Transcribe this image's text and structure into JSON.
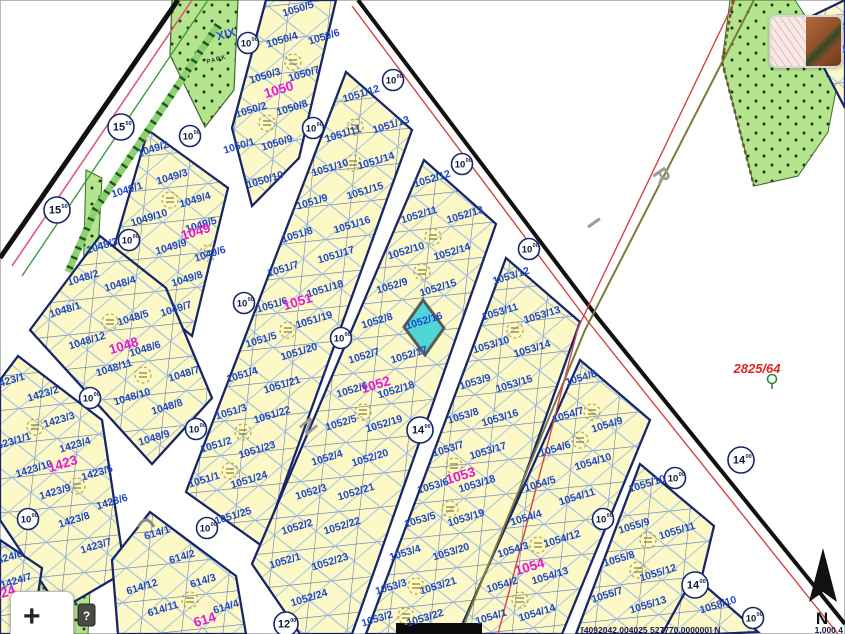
{
  "map": {
    "colors": {
      "parcel_number": "#1d46c8",
      "block_number": "#e318d6",
      "highlight_fill": "#4fd6d6",
      "selection_outline": "#5a5a5a",
      "survey_red": "#e02525"
    },
    "highlight": {
      "parcel": "1052/16"
    },
    "parcel_labels": [
      {
        "t": "1050/5",
        "x": 299,
        "y": 12
      },
      {
        "t": "1050/4",
        "x": 283,
        "y": 43
      },
      {
        "t": "1050/6",
        "x": 325,
        "y": 40
      },
      {
        "t": "1050/3",
        "x": 266,
        "y": 79
      },
      {
        "t": "1050/7",
        "x": 305,
        "y": 77
      },
      {
        "t": "1050/2",
        "x": 252,
        "y": 113
      },
      {
        "t": "1050/8",
        "x": 293,
        "y": 111
      },
      {
        "t": "1050/1",
        "x": 240,
        "y": 149
      },
      {
        "t": "1050/9",
        "x": 278,
        "y": 146
      },
      {
        "t": "1050/10",
        "x": 266,
        "y": 183
      },
      {
        "t": "1051/12",
        "x": 362,
        "y": 97
      },
      {
        "t": "1051/13",
        "x": 392,
        "y": 128
      },
      {
        "t": "1051/11",
        "x": 344,
        "y": 137
      },
      {
        "t": "1051/14",
        "x": 377,
        "y": 164
      },
      {
        "t": "1051/10",
        "x": 331,
        "y": 171
      },
      {
        "t": "1051/15",
        "x": 366,
        "y": 194
      },
      {
        "t": "1051/9",
        "x": 313,
        "y": 205
      },
      {
        "t": "1051/16",
        "x": 353,
        "y": 228
      },
      {
        "t": "1051/8",
        "x": 298,
        "y": 238
      },
      {
        "t": "1051/17",
        "x": 337,
        "y": 258
      },
      {
        "t": "1051/7",
        "x": 284,
        "y": 272
      },
      {
        "t": "1051/18",
        "x": 326,
        "y": 292
      },
      {
        "t": "1051/6",
        "x": 273,
        "y": 308
      },
      {
        "t": "1051/19",
        "x": 315,
        "y": 323
      },
      {
        "t": "1051/5",
        "x": 262,
        "y": 343
      },
      {
        "t": "1051/20",
        "x": 300,
        "y": 355
      },
      {
        "t": "1051/4",
        "x": 243,
        "y": 378
      },
      {
        "t": "1051/21",
        "x": 283,
        "y": 388
      },
      {
        "t": "1051/3",
        "x": 232,
        "y": 415
      },
      {
        "t": "1051/22",
        "x": 273,
        "y": 418
      },
      {
        "t": "1051/2",
        "x": 217,
        "y": 448
      },
      {
        "t": "1051/23",
        "x": 258,
        "y": 453
      },
      {
        "t": "1051/1",
        "x": 205,
        "y": 483
      },
      {
        "t": "1051/24",
        "x": 250,
        "y": 483
      },
      {
        "t": "1051/25",
        "x": 234,
        "y": 519
      },
      {
        "t": "1052/12",
        "x": 433,
        "y": 182
      },
      {
        "t": "1052/11",
        "x": 420,
        "y": 218
      },
      {
        "t": "1052/13",
        "x": 466,
        "y": 218
      },
      {
        "t": "1052/10",
        "x": 407,
        "y": 254
      },
      {
        "t": "1052/14",
        "x": 453,
        "y": 255
      },
      {
        "t": "1052/9",
        "x": 393,
        "y": 289
      },
      {
        "t": "1052/15",
        "x": 439,
        "y": 291
      },
      {
        "t": "1052/8",
        "x": 378,
        "y": 324
      },
      {
        "t": "1052/16",
        "x": 425,
        "y": 324
      },
      {
        "t": "1052/7",
        "x": 365,
        "y": 359
      },
      {
        "t": "1052/17",
        "x": 410,
        "y": 358
      },
      {
        "t": "1052/6",
        "x": 353,
        "y": 393
      },
      {
        "t": "1052/18",
        "x": 397,
        "y": 393
      },
      {
        "t": "1052/5",
        "x": 342,
        "y": 426
      },
      {
        "t": "1052/19",
        "x": 385,
        "y": 427
      },
      {
        "t": "1052/4",
        "x": 328,
        "y": 461
      },
      {
        "t": "1052/20",
        "x": 371,
        "y": 461
      },
      {
        "t": "1052/3",
        "x": 312,
        "y": 495
      },
      {
        "t": "1052/21",
        "x": 357,
        "y": 495
      },
      {
        "t": "1052/2",
        "x": 298,
        "y": 530
      },
      {
        "t": "1052/22",
        "x": 343,
        "y": 529
      },
      {
        "t": "1052/1",
        "x": 286,
        "y": 564
      },
      {
        "t": "1052/23",
        "x": 331,
        "y": 565
      },
      {
        "t": "1052/24",
        "x": 310,
        "y": 601
      },
      {
        "t": "1053/12",
        "x": 512,
        "y": 279
      },
      {
        "t": "1053/11",
        "x": 501,
        "y": 315
      },
      {
        "t": "1053/13",
        "x": 543,
        "y": 318
      },
      {
        "t": "1053/10",
        "x": 492,
        "y": 348
      },
      {
        "t": "1053/14",
        "x": 533,
        "y": 352
      },
      {
        "t": "1053/9",
        "x": 476,
        "y": 385
      },
      {
        "t": "1053/15",
        "x": 515,
        "y": 387
      },
      {
        "t": "1053/8",
        "x": 464,
        "y": 419
      },
      {
        "t": "1053/16",
        "x": 501,
        "y": 421
      },
      {
        "t": "1053/7",
        "x": 449,
        "y": 452
      },
      {
        "t": "1053/17",
        "x": 489,
        "y": 454
      },
      {
        "t": "1053/6",
        "x": 434,
        "y": 489
      },
      {
        "t": "1053/18",
        "x": 478,
        "y": 487
      },
      {
        "t": "1053/5",
        "x": 421,
        "y": 523
      },
      {
        "t": "1053/19",
        "x": 467,
        "y": 521
      },
      {
        "t": "1053/4",
        "x": 406,
        "y": 556
      },
      {
        "t": "1053/20",
        "x": 452,
        "y": 555
      },
      {
        "t": "1053/3",
        "x": 392,
        "y": 590
      },
      {
        "t": "1053/21",
        "x": 439,
        "y": 589
      },
      {
        "t": "1053/2",
        "x": 378,
        "y": 622
      },
      {
        "t": "1053/22",
        "x": 426,
        "y": 621
      },
      {
        "t": "1054/8",
        "x": 582,
        "y": 381
      },
      {
        "t": "1054/7",
        "x": 569,
        "y": 418
      },
      {
        "t": "1054/9",
        "x": 608,
        "y": 428
      },
      {
        "t": "1054/6",
        "x": 556,
        "y": 452
      },
      {
        "t": "1054/10",
        "x": 594,
        "y": 465
      },
      {
        "t": "1054/5",
        "x": 541,
        "y": 487
      },
      {
        "t": "1054/11",
        "x": 578,
        "y": 500
      },
      {
        "t": "1054/4",
        "x": 527,
        "y": 521
      },
      {
        "t": "1054/12",
        "x": 563,
        "y": 542
      },
      {
        "t": "1054/3",
        "x": 514,
        "y": 553
      },
      {
        "t": "1054/13",
        "x": 551,
        "y": 579
      },
      {
        "t": "1054/2",
        "x": 503,
        "y": 588
      },
      {
        "t": "1054/14",
        "x": 538,
        "y": 616
      },
      {
        "t": "1054/1",
        "x": 492,
        "y": 620
      },
      {
        "t": "1055/10",
        "x": 648,
        "y": 487
      },
      {
        "t": "1055/9",
        "x": 635,
        "y": 529
      },
      {
        "t": "1055/11",
        "x": 678,
        "y": 534
      },
      {
        "t": "1055/8",
        "x": 620,
        "y": 562
      },
      {
        "t": "1055/12",
        "x": 659,
        "y": 576
      },
      {
        "t": "1055/7",
        "x": 608,
        "y": 598
      },
      {
        "t": "1055/13",
        "x": 649,
        "y": 608
      },
      {
        "t": "1058/10",
        "x": 719,
        "y": 608
      },
      {
        "t": "1049/2",
        "x": 154,
        "y": 152
      },
      {
        "t": "1049/3",
        "x": 173,
        "y": 180
      },
      {
        "t": "1049/1",
        "x": 128,
        "y": 193
      },
      {
        "t": "1049/4",
        "x": 196,
        "y": 203
      },
      {
        "t": "1049/10",
        "x": 150,
        "y": 221
      },
      {
        "t": "1049/5",
        "x": 202,
        "y": 228
      },
      {
        "t": "1049/9",
        "x": 172,
        "y": 250
      },
      {
        "t": "1049/6",
        "x": 211,
        "y": 257
      },
      {
        "t": "1049/8",
        "x": 188,
        "y": 282
      },
      {
        "t": "1049/7",
        "x": 177,
        "y": 312
      },
      {
        "t": "1048/3",
        "x": 103,
        "y": 249
      },
      {
        "t": "1048/2",
        "x": 84,
        "y": 281
      },
      {
        "t": "1048/4",
        "x": 121,
        "y": 287
      },
      {
        "t": "1048/1",
        "x": 66,
        "y": 313
      },
      {
        "t": "1048/5",
        "x": 134,
        "y": 321
      },
      {
        "t": "1048/12",
        "x": 88,
        "y": 344
      },
      {
        "t": "1048/6",
        "x": 146,
        "y": 352
      },
      {
        "t": "1048/11",
        "x": 115,
        "y": 371
      },
      {
        "t": "1048/7",
        "x": 185,
        "y": 377
      },
      {
        "t": "1048/10",
        "x": 133,
        "y": 400
      },
      {
        "t": "1048/8",
        "x": 168,
        "y": 410
      },
      {
        "t": "1048/9",
        "x": 155,
        "y": 441
      },
      {
        "t": "1423/1",
        "x": 10,
        "y": 384
      },
      {
        "t": "1423/2",
        "x": 44,
        "y": 397
      },
      {
        "t": "1423/3",
        "x": 60,
        "y": 423
      },
      {
        "t": "1423/1/1",
        "x": 12,
        "y": 445
      },
      {
        "t": "1423/4",
        "x": 76,
        "y": 448
      },
      {
        "t": "1423/10",
        "x": 35,
        "y": 472
      },
      {
        "t": "1423/5",
        "x": 98,
        "y": 476
      },
      {
        "t": "1423/9",
        "x": 56,
        "y": 495
      },
      {
        "t": "1423/6",
        "x": 113,
        "y": 505
      },
      {
        "t": "1423/8",
        "x": 75,
        "y": 523
      },
      {
        "t": "1423/7",
        "x": 97,
        "y": 549
      },
      {
        "t": "1424/6",
        "x": 8,
        "y": 561
      },
      {
        "t": "1424/7",
        "x": 17,
        "y": 584
      },
      {
        "t": "614/1",
        "x": 158,
        "y": 536
      },
      {
        "t": "614/2",
        "x": 183,
        "y": 560
      },
      {
        "t": "614/12",
        "x": 143,
        "y": 590
      },
      {
        "t": "614/3",
        "x": 204,
        "y": 584
      },
      {
        "t": "614/11",
        "x": 164,
        "y": 612
      },
      {
        "t": "614/4",
        "x": 227,
        "y": 610
      },
      {
        "t": "12",
        "x": 840,
        "y": 30
      },
      {
        "t": "10",
        "x": 841,
        "y": 53
      }
    ],
    "block_labels": [
      {
        "t": "1050",
        "x": 280,
        "y": 94
      },
      {
        "t": "1049",
        "x": 197,
        "y": 236
      },
      {
        "t": "1048",
        "x": 125,
        "y": 350
      },
      {
        "t": "1423",
        "x": 64,
        "y": 468
      },
      {
        "t": "1424",
        "x": 2,
        "y": 598
      },
      {
        "t": "614",
        "x": 206,
        "y": 624
      },
      {
        "t": "1051",
        "x": 299,
        "y": 306
      },
      {
        "t": "1052",
        "x": 377,
        "y": 389
      },
      {
        "t": "1053",
        "x": 462,
        "y": 480
      },
      {
        "t": "1054",
        "x": 531,
        "y": 571
      }
    ],
    "road_width_markers": [
      {
        "t": "15",
        "s": "50",
        "x": 121,
        "y": 127,
        "r": 13
      },
      {
        "t": "15",
        "s": "50",
        "x": 57,
        "y": 210,
        "r": 13
      },
      {
        "t": "10",
        "s": "00",
        "x": 248,
        "y": 43,
        "r": 10.5
      },
      {
        "t": "10",
        "s": "00",
        "x": 190,
        "y": 136,
        "r": 10.5
      },
      {
        "t": "10",
        "s": "00",
        "x": 313,
        "y": 128,
        "r": 10.5
      },
      {
        "t": "10",
        "s": "00",
        "x": 393,
        "y": 80,
        "r": 10.5
      },
      {
        "t": "10",
        "s": "00",
        "x": 462,
        "y": 164,
        "r": 10.5
      },
      {
        "t": "10",
        "s": "00",
        "x": 529,
        "y": 249,
        "r": 10.5
      },
      {
        "t": "10",
        "s": "00",
        "x": 129,
        "y": 240,
        "r": 10.5
      },
      {
        "t": "10",
        "s": "00",
        "x": 244,
        "y": 303,
        "r": 10.5
      },
      {
        "t": "10",
        "s": "00",
        "x": 341,
        "y": 338,
        "r": 10.5
      },
      {
        "t": "10",
        "s": "00",
        "x": 90,
        "y": 398,
        "r": 10.5
      },
      {
        "t": "10",
        "s": "00",
        "x": 196,
        "y": 429,
        "r": 10.5
      },
      {
        "t": "10",
        "s": "00",
        "x": 28,
        "y": 519,
        "r": 10.5
      },
      {
        "t": "10",
        "s": "00",
        "x": 207,
        "y": 528,
        "r": 10.5
      },
      {
        "t": "10",
        "s": "00",
        "x": 675,
        "y": 478,
        "r": 10.5
      },
      {
        "t": "10",
        "s": "00",
        "x": 603,
        "y": 519,
        "r": 10.5
      },
      {
        "t": "10",
        "s": "00",
        "x": 753,
        "y": 618,
        "r": 10.5
      },
      {
        "t": "14",
        "s": "00",
        "x": 420,
        "y": 430,
        "r": 13
      },
      {
        "t": "14",
        "s": "00",
        "x": 741,
        "y": 460,
        "r": 13
      },
      {
        "t": "14",
        "s": "00",
        "x": 695,
        "y": 585,
        "r": 13
      },
      {
        "t": "12",
        "s": "00",
        "x": 286,
        "y": 624,
        "r": 12
      }
    ],
    "street_letters": [
      {
        "t": "R",
        "x": 656,
        "y": 180,
        "rot": 55
      },
      {
        "t": "I",
        "x": 588,
        "y": 227,
        "rot": 55
      },
      {
        "t": "N",
        "x": 303,
        "y": 431,
        "rot": 50
      }
    ],
    "annotations": [
      {
        "t": "XIX",
        "x": 227,
        "y": 38,
        "k": "district"
      },
      {
        "t": "PARK",
        "x": 217,
        "y": 61,
        "k": "park"
      },
      {
        "t": "2825/64",
        "x": 757,
        "y": 373,
        "k": "survey"
      }
    ],
    "status": {
      "coordinates": "[4092042.004025 527770.000000] N",
      "scale": "1,000 4"
    },
    "compass": {
      "label": "N"
    },
    "controls": {
      "zoom_in_label": "+"
    }
  }
}
